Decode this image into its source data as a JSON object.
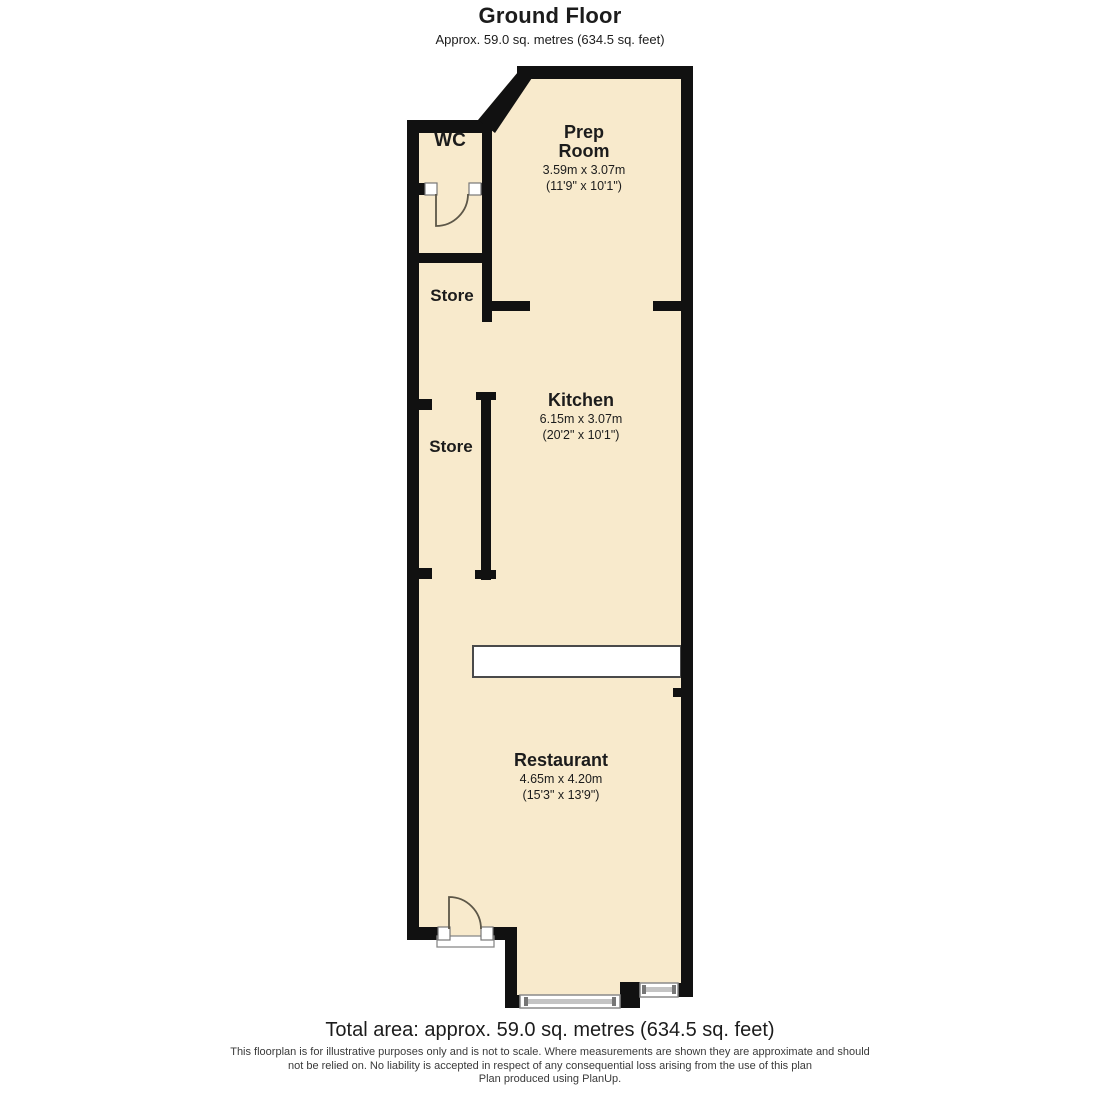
{
  "header": {
    "title": "Ground Floor",
    "subtitle": "Approx. 59.0 sq. metres (634.5 sq. feet)"
  },
  "rooms": {
    "wc": {
      "name": "WC"
    },
    "prep_room": {
      "name_line1": "Prep",
      "name_line2": "Room",
      "dims_metric": "3.59m x 3.07m",
      "dims_imperial": "(11'9\" x 10'1\")"
    },
    "store_upper": {
      "name": "Store"
    },
    "kitchen": {
      "name": "Kitchen",
      "dims_metric": "6.15m x 3.07m",
      "dims_imperial": "(20'2\" x 10'1\")"
    },
    "store_lower": {
      "name": "Store"
    },
    "restaurant": {
      "name": "Restaurant",
      "dims_metric": "4.65m x 4.20m",
      "dims_imperial": "(15'3\" x 13'9\")"
    }
  },
  "footer": {
    "total_area": "Total area: approx. 59.0 sq. metres (634.5 sq. feet)",
    "disclaimer_line1": "This floorplan is for illustrative purposes only and is not to scale. Where measurements are shown they are approximate and should",
    "disclaimer_line2": "not be relied on. No liability is accepted in respect of any consequential loss arising from the use of this plan",
    "disclaimer_line3": "Plan produced using PlanUp."
  },
  "colors": {
    "floor_fill": "#f8eacc",
    "wall": "#111111",
    "window_frame": "#8a8a8a",
    "door_arc": "#5d5748"
  }
}
